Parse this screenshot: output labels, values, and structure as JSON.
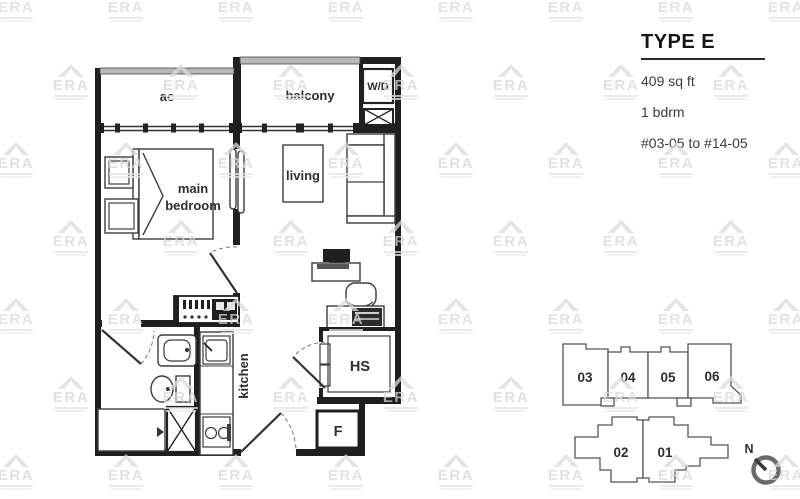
{
  "watermark": {
    "text": "ERA"
  },
  "title_block": {
    "title": "TYPE E",
    "area": "409 sq ft",
    "bedrooms": "1 bdrm",
    "unit_range": "#03-05 to #14-05"
  },
  "floor_plan": {
    "labels": {
      "ac": "ac",
      "balcony": "balcony",
      "washer_dryer": "W/D",
      "bedroom_line1": "main",
      "bedroom_line2": "bedroom",
      "living": "living",
      "kitchen": "kitchen",
      "household_shelter": "HS",
      "fridge": "F"
    }
  },
  "key_plan": {
    "top_units": [
      "03",
      "04",
      "05",
      "06"
    ],
    "bottom_units": [
      "02",
      "01"
    ],
    "highlighted_unit": "05",
    "highlight_color": "#e8e8e8",
    "north": "N"
  }
}
